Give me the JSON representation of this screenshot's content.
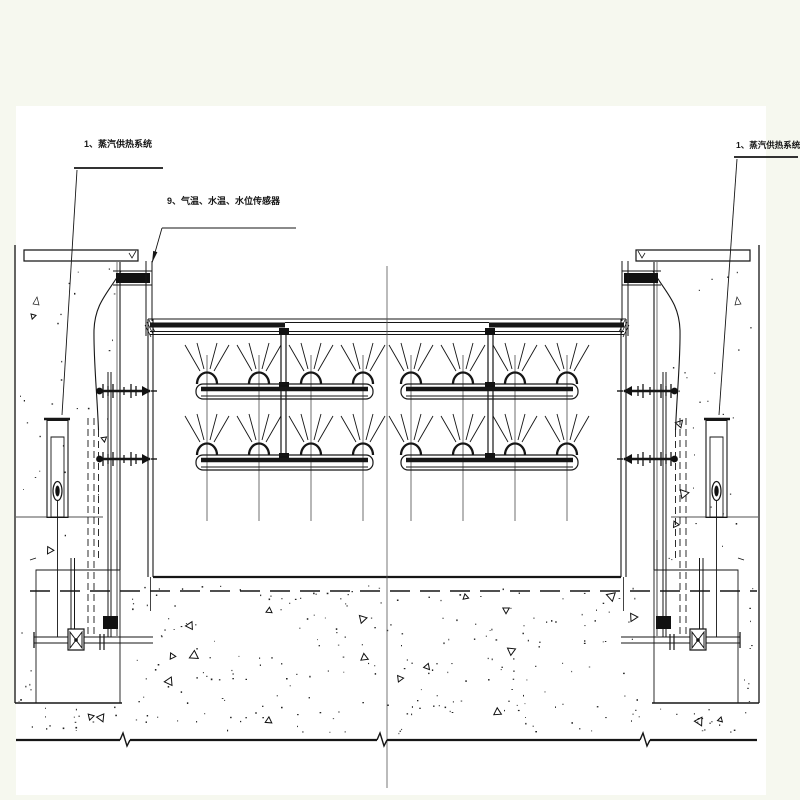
{
  "labels": {
    "steam_left": "1、蒸汽供热系统",
    "sensors": "9、气温、水温、水位传感器",
    "steam_right": "1、蒸汽供热系统"
  },
  "colors": {
    "background": "#f6f8ef",
    "paper": "#ffffff",
    "ink": "#161616"
  },
  "drawing": {
    "kind_note": "engineering elevation drawing, black line work on white paper"
  }
}
